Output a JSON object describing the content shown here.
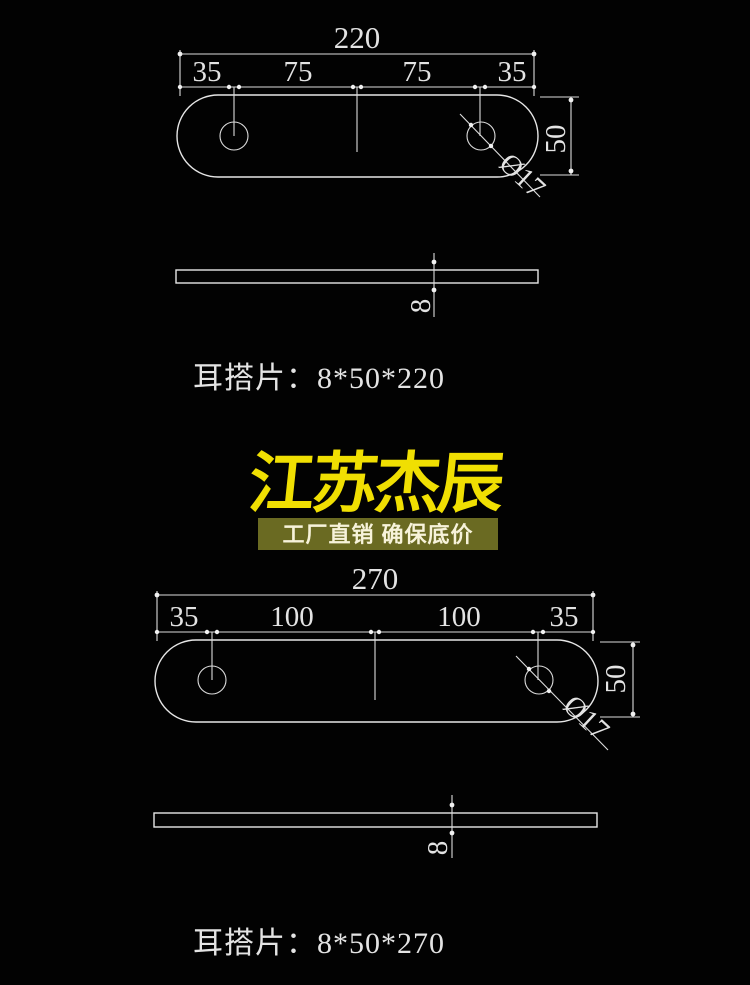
{
  "page": {
    "background": "#020202",
    "line_color": "#e6e6e6",
    "text_color": "#e3e3e3"
  },
  "drawing_top": {
    "title": "耳搭片：8*50*220",
    "total_width": "220",
    "segments": [
      "35",
      "75",
      "75",
      "35"
    ],
    "height": "50",
    "hole_diameter": "Ø17",
    "thickness": "8"
  },
  "logo": {
    "brand": "江苏杰辰",
    "tagline": "工厂直销 确保底价",
    "brand_color": "#f0df02",
    "tagline_bg": "#6a6a22",
    "tagline_color": "#f7f3da"
  },
  "drawing_bottom": {
    "title": "耳搭片：8*50*270",
    "total_width": "270",
    "segments": [
      "35",
      "100",
      "100",
      "35"
    ],
    "height": "50",
    "hole_diameter": "Ø17",
    "thickness": "8"
  }
}
